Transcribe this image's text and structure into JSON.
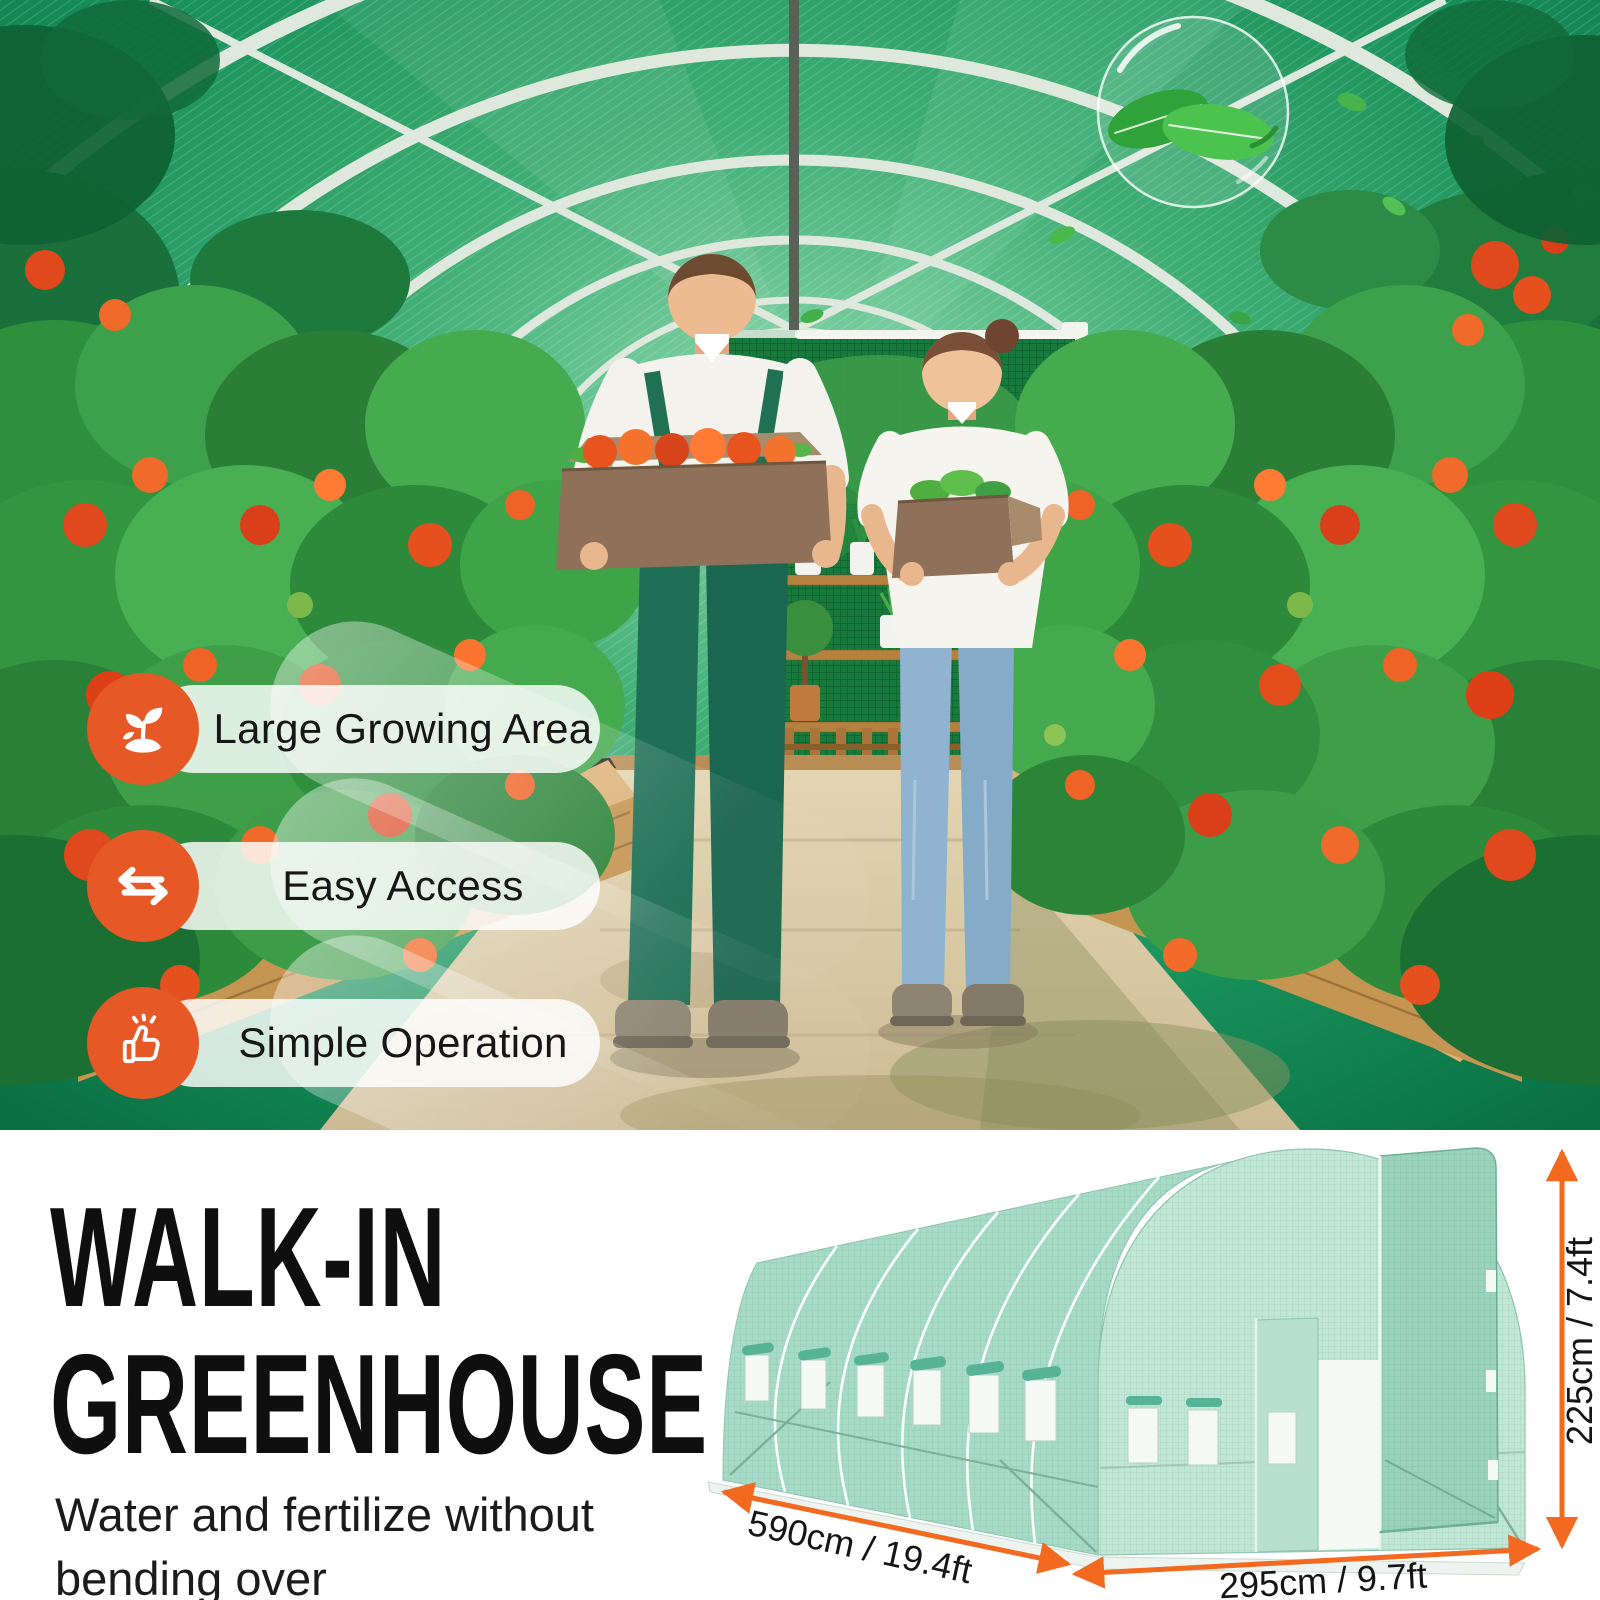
{
  "photo": {
    "badge_accent_color": "#e65826",
    "badges": [
      {
        "icon": "sprout-icon",
        "label": "Large Growing Area"
      },
      {
        "icon": "exchange-arrows-icon",
        "label": "Easy Access"
      },
      {
        "icon": "thumbs-up-icon",
        "label": "Simple Operation"
      }
    ]
  },
  "info": {
    "title_line1": "WALK-IN",
    "title_line2": "GREENHOUSE",
    "subtitle": "Water and fertilize without bending over"
  },
  "diagram": {
    "arrow_color": "#f2691f",
    "cover_color": "#b7e0cf",
    "dimensions": {
      "length": "590cm / 19.4ft",
      "width": "295cm / 9.7ft",
      "height": "225cm / 7.4ft"
    }
  }
}
